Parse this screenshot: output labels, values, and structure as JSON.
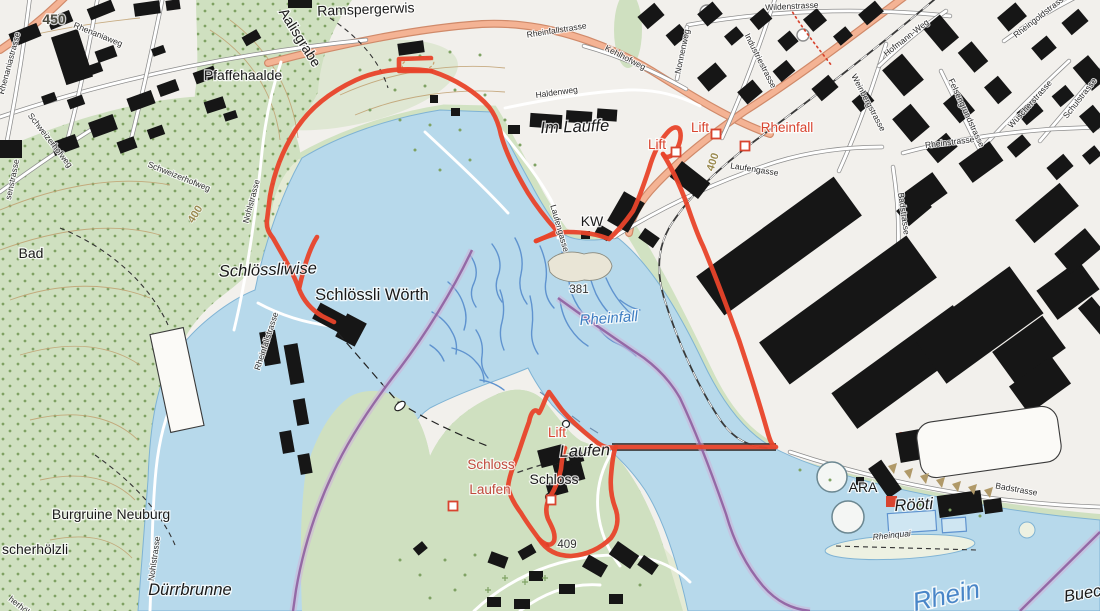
{
  "map": {
    "description": "Swiss topographic map extract of the Rheinfall area with a red hiking route loop",
    "colors": {
      "water": "#b7d9eb",
      "water_stream": "#5f93cf",
      "forest": "#cfe0c0",
      "building": "#161616",
      "route": "#e8432a",
      "boundary": "#8f5fa0",
      "main_road": "#f4b394",
      "poi_label": "#d8442f",
      "water_label": "#3d7dc2",
      "contour_label": "#9a8a4f"
    },
    "route": {
      "type": "hiking route loop",
      "color": "#e8432a"
    },
    "labels": [
      {
        "t": "450",
        "x": 54,
        "y": 24,
        "r": 0,
        "c": "elev"
      },
      {
        "t": "Ramspergerwis",
        "x": 366,
        "y": 14,
        "r": -2,
        "c": "place"
      },
      {
        "t": "Aalisgrabe",
        "x": 296,
        "y": 40,
        "r": 58,
        "c": "place"
      },
      {
        "t": "Pfaffehaalde",
        "x": 243,
        "y": 80,
        "r": 0,
        "c": "place"
      },
      {
        "t": "Rheinfallstrasse",
        "x": 557,
        "y": 33,
        "r": -9,
        "c": "street"
      },
      {
        "t": "Kehlhofweg",
        "x": 624,
        "y": 60,
        "r": 27,
        "c": "street"
      },
      {
        "t": "Wildenstrasse",
        "x": 792,
        "y": 9,
        "r": -3,
        "c": "street"
      },
      {
        "t": "Nonnenweg",
        "x": 685,
        "y": 52,
        "r": -78,
        "c": "street"
      },
      {
        "t": "Industriestrasse",
        "x": 758,
        "y": 62,
        "r": 63,
        "c": "street"
      },
      {
        "t": "Hofmann-Weg",
        "x": 908,
        "y": 40,
        "r": -38,
        "c": "street"
      },
      {
        "t": "Rheingoldstrasse",
        "x": 1042,
        "y": 18,
        "r": -38,
        "c": "street"
      },
      {
        "t": "Weinbergstrasse",
        "x": 866,
        "y": 104,
        "r": 62,
        "c": "street"
      },
      {
        "t": "Felsengrundstrasse",
        "x": 964,
        "y": 114,
        "r": 65,
        "c": "street"
      },
      {
        "t": "Wüscherstrasse",
        "x": 1032,
        "y": 106,
        "r": -48,
        "c": "street"
      },
      {
        "t": "Schulstrasse",
        "x": 1082,
        "y": 100,
        "r": -52,
        "c": "street"
      },
      {
        "t": "Rheinstrasse",
        "x": 950,
        "y": 145,
        "r": -7,
        "c": "street"
      },
      {
        "t": "Haldenweg",
        "x": 557,
        "y": 95,
        "r": -8,
        "c": "street"
      },
      {
        "t": "Im Lauffe",
        "x": 575,
        "y": 132,
        "r": -2,
        "c": "place-lg i"
      },
      {
        "t": "Lift",
        "x": 657,
        "y": 149,
        "r": 0,
        "c": "poi"
      },
      {
        "t": "Lift",
        "x": 700,
        "y": 132,
        "r": 0,
        "c": "poi"
      },
      {
        "t": "Rheinfall",
        "x": 787,
        "y": 132,
        "r": 0,
        "c": "poi"
      },
      {
        "t": "400",
        "x": 716,
        "y": 163,
        "r": -72,
        "c": "contour"
      },
      {
        "t": "Laufengasse",
        "x": 754,
        "y": 172,
        "r": 9,
        "c": "street"
      },
      {
        "t": "KW",
        "x": 592,
        "y": 226,
        "r": 0,
        "c": "place"
      },
      {
        "t": "Laufengasse",
        "x": 557,
        "y": 229,
        "r": 74,
        "c": "street"
      },
      {
        "t": "Badstrasse",
        "x": 901,
        "y": 214,
        "r": 82,
        "c": "street"
      },
      {
        "t": "400",
        "x": 198,
        "y": 216,
        "r": -58,
        "c": "contour"
      },
      {
        "t": "Bad",
        "x": 31,
        "y": 258,
        "r": 0,
        "c": "place"
      },
      {
        "t": "Nohlstrasse",
        "x": 254,
        "y": 202,
        "r": -75,
        "c": "street"
      },
      {
        "t": "senstrasse",
        "x": 15,
        "y": 180,
        "r": -78,
        "c": "street"
      },
      {
        "t": "Rhenaniastrasse",
        "x": 12,
        "y": 64,
        "r": -75,
        "c": "street"
      },
      {
        "t": "Rhenaniaweg",
        "x": 97,
        "y": 37,
        "r": 22,
        "c": "street"
      },
      {
        "t": "Schweizerhofweg",
        "x": 48,
        "y": 142,
        "r": 52,
        "c": "street"
      },
      {
        "t": "Schweizerhofweg",
        "x": 178,
        "y": 179,
        "r": 22,
        "c": "street"
      },
      {
        "t": "Schlössliwise",
        "x": 268,
        "y": 275,
        "r": -2,
        "c": "place-lg i"
      },
      {
        "t": "Schlössli Wörth",
        "x": 372,
        "y": 300,
        "r": 0,
        "c": "place-lg"
      },
      {
        "t": "Rheinfallstrasse",
        "x": 269,
        "y": 342,
        "r": -72,
        "c": "street"
      },
      {
        "t": "381",
        "x": 579,
        "y": 293,
        "r": 0,
        "c": "elev-sm"
      },
      {
        "t": "Rheinfall",
        "x": 609,
        "y": 323,
        "r": -4,
        "c": "water"
      },
      {
        "t": "Schloss",
        "x": 491,
        "y": 469,
        "r": 0,
        "c": "poi-dark"
      },
      {
        "t": "Laufen",
        "x": 490,
        "y": 494,
        "r": 0,
        "c": "poi-dark"
      },
      {
        "t": "Lift",
        "x": 557,
        "y": 437,
        "r": 0,
        "c": "poi"
      },
      {
        "t": "Laufen",
        "x": 585,
        "y": 456,
        "r": -2,
        "c": "place-lg i"
      },
      {
        "t": "Schloss",
        "x": 554,
        "y": 484,
        "r": 0,
        "c": "place"
      },
      {
        "t": "409",
        "x": 567,
        "y": 548,
        "r": 0,
        "c": "elev-sm"
      },
      {
        "t": "Burgruine Neuburg",
        "x": 111,
        "y": 519,
        "r": 0,
        "c": "place"
      },
      {
        "t": "scherhölzli",
        "x": 2,
        "y": 554,
        "r": 0,
        "c": "place",
        "a": "start"
      },
      {
        "t": "Dürrbrunne",
        "x": 190,
        "y": 595,
        "r": 0,
        "c": "place-lg i"
      },
      {
        "t": "Nohlstrasse",
        "x": 157,
        "y": 559,
        "r": -82,
        "c": "street"
      },
      {
        "t": "herhölzlistr.",
        "x": 8,
        "y": 600,
        "r": 38,
        "c": "street",
        "a": "start"
      },
      {
        "t": "ARA",
        "x": 863,
        "y": 492,
        "r": 0,
        "c": "place"
      },
      {
        "t": "Rööti",
        "x": 914,
        "y": 510,
        "r": -3,
        "c": "place-lg i"
      },
      {
        "t": "Badstrasse",
        "x": 1016,
        "y": 492,
        "r": 10,
        "c": "street"
      },
      {
        "t": "Rheinquai",
        "x": 892,
        "y": 538,
        "r": -6,
        "c": "street i"
      },
      {
        "t": "Rhein",
        "x": 948,
        "y": 604,
        "r": -12,
        "c": "water-lg"
      },
      {
        "t": "Buech",
        "x": 1088,
        "y": 598,
        "r": -10,
        "c": "place-lg i"
      }
    ],
    "stop_markers": [
      {
        "x": 676,
        "y": 152
      },
      {
        "x": 716,
        "y": 134
      },
      {
        "x": 745,
        "y": 146
      },
      {
        "x": 453,
        "y": 506
      },
      {
        "x": 551,
        "y": 500
      }
    ],
    "poi_red_square": {
      "x": 891,
      "y": 501
    }
  }
}
